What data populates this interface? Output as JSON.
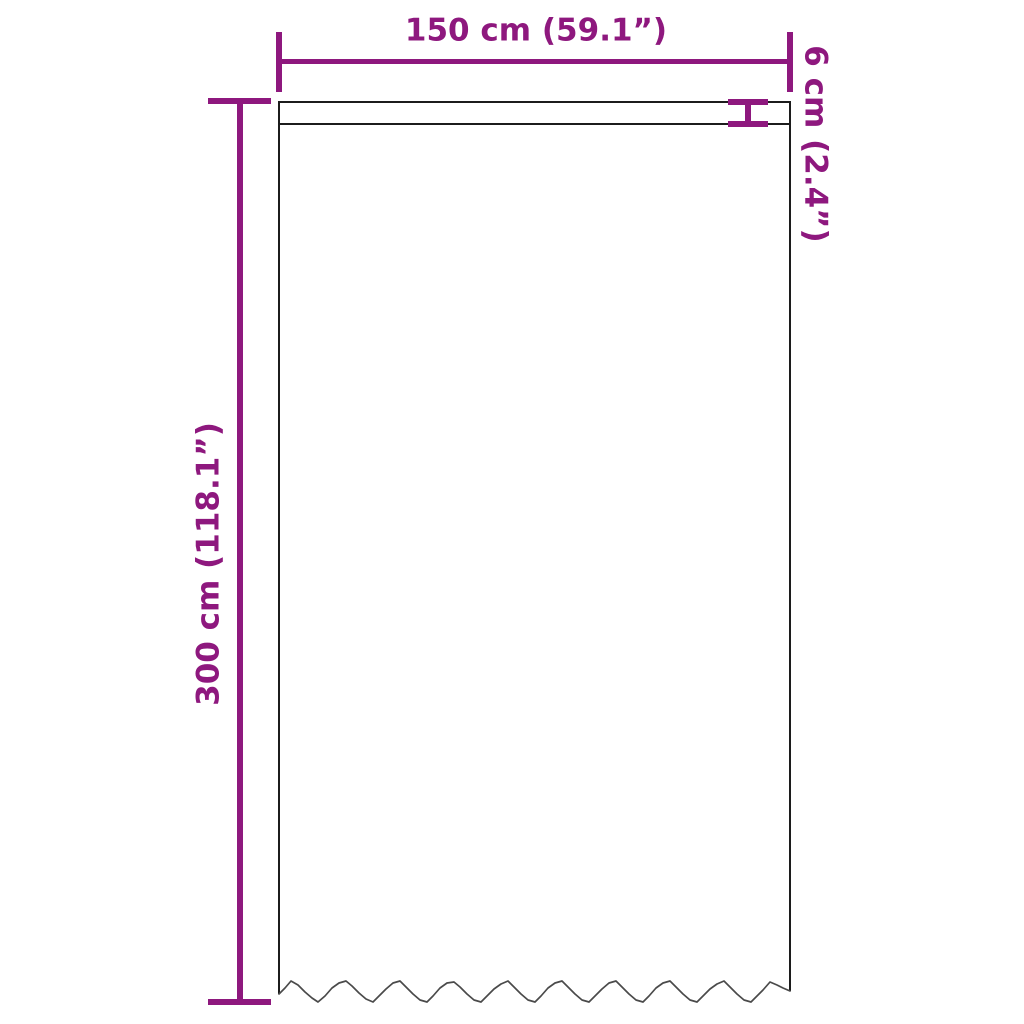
{
  "diagram": {
    "kind": "curtain-dimension-drawing",
    "colors": {
      "accent": "#8e187e",
      "outline": "#1c1c1c",
      "hem": "#4a4a4a",
      "background": "#ffffff"
    },
    "dimensions": {
      "width": {
        "label": "150 cm (59.1”)",
        "cm": 150,
        "inches": 59.1,
        "orientation": "horizontal",
        "position": "top"
      },
      "drop": {
        "label": "300 cm (118.1”)",
        "cm": 300,
        "inches": 118.1,
        "orientation": "vertical",
        "position": "left"
      },
      "header": {
        "label": "6 cm (2.4”)",
        "cm": 6,
        "inches": 2.4,
        "orientation": "vertical",
        "position": "top-right"
      }
    }
  }
}
